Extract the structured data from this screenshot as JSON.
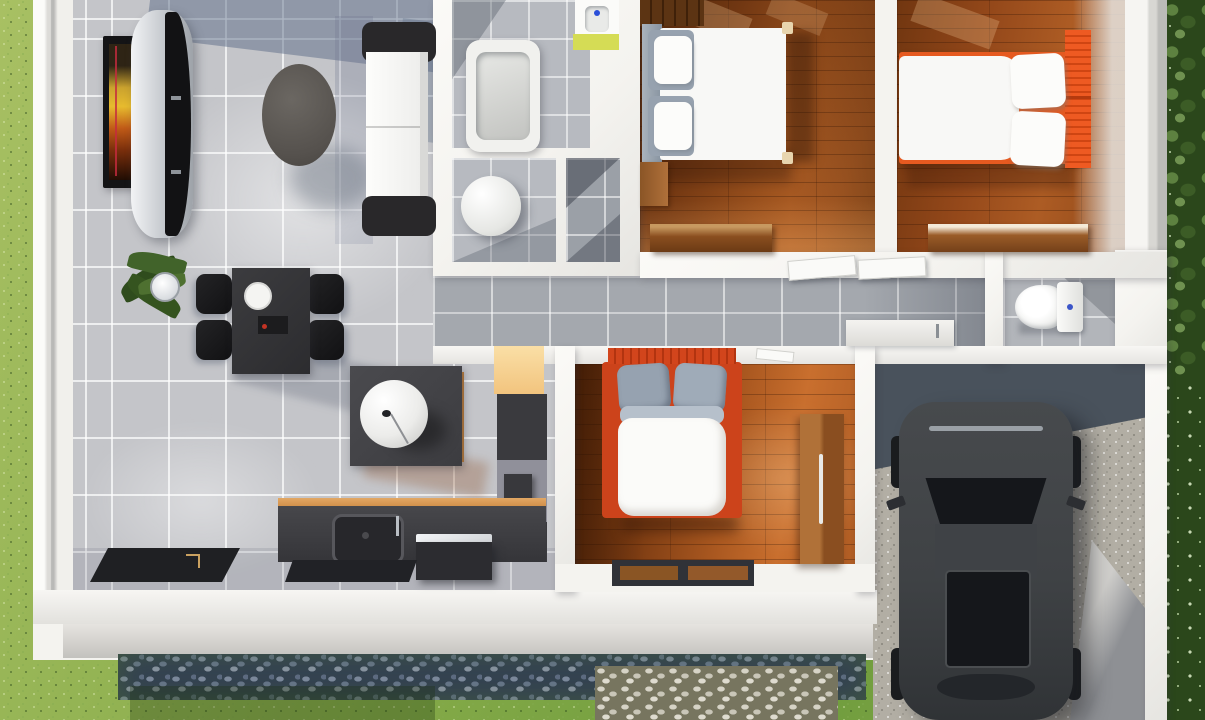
{
  "scene": {
    "description": "3D rendered top-down floor plan of a single-storey house: gray-tile open living/dining/kitchen, bathroom with tub, three wood-floor bedrooms with white bedding and orange headboards, hallway, guest WC, and a gravel carport with a dark SUV, surrounded by lawn, shrubs and cobblestone paths"
  },
  "labels": {
    "garden": "lawn garden",
    "shrubs": "shrubs and trees",
    "living_room": "living room",
    "dining_area": "dining area",
    "kitchen": "kitchen",
    "bathroom": "bathroom with bathtub",
    "wc_small": "toilet room",
    "shower_room": "shower room",
    "bedroom_1": "bedroom 1",
    "bedroom_2": "bedroom 2",
    "bedroom_3": "bedroom 3",
    "hallway": "hallway",
    "toilet_right": "guest WC",
    "garage": "carport",
    "driveway": "gravel driveway",
    "path": "cobblestone path",
    "sofa": "white sofa with dark armrests",
    "tv_cabinet": "curved TV cabinet",
    "wall_art": "framed wall art",
    "coffee_table": "oval coffee table",
    "dining_table": "dining table with four chairs",
    "plant": "potted plant",
    "island_lamp": "island unit with sphere lamp",
    "kitchen_counter": "kitchen counter with sink",
    "bathtub": "bathtub",
    "vanity": "wash basin",
    "toilet": "toilet",
    "bed_1": "double bed with gray pillows",
    "bed_2": "double bed with orange headboard",
    "bed_3": "double bed with orange headboard",
    "wardrobe": "wooden wardrobe",
    "car": "dark SUV"
  },
  "colors": {
    "grass_hi": "#a8c063",
    "grass_mid": "#86ab49",
    "grass_lo": "#6f9c3d",
    "tree_dark": "#2b471b",
    "tree_leaf": "#5d8140",
    "wall": "#f4f3ef",
    "wall_shade": "#d9d8d4",
    "wall_dark": "#b7b7b4",
    "tile": "#c4c5c9",
    "tile_shadow": "#5c6c8c",
    "hall_tile": "#a4a8ae",
    "bath_tile": "#b7bac0",
    "wood1_mid": "#9c521e",
    "wood1_hi": "#c06f2e",
    "wood2_mid": "#ad5c24",
    "wood3_mid": "#aa5820",
    "accent": "#ee5a22",
    "headboard3": "#d2451c",
    "furn_dark": "#3c3c40",
    "furn_black": "#1c1c1e",
    "cream": "#f8dca2",
    "wood_trim": "#d09a58",
    "lime": "#d5dc55",
    "white_soft": "#f8f8f6",
    "pillow_gray": "#97a2af",
    "car_body": "#3f4245",
    "car_glass": "#15171b",
    "slate": "#49525c",
    "gravel": "#b2aea4",
    "cobble_dark_gap": "#334152",
    "cobble_dark_stone": "#7d89a0",
    "cobble_light_gap": "#77755f",
    "cobble_light_stone": "#d6d3c6"
  }
}
